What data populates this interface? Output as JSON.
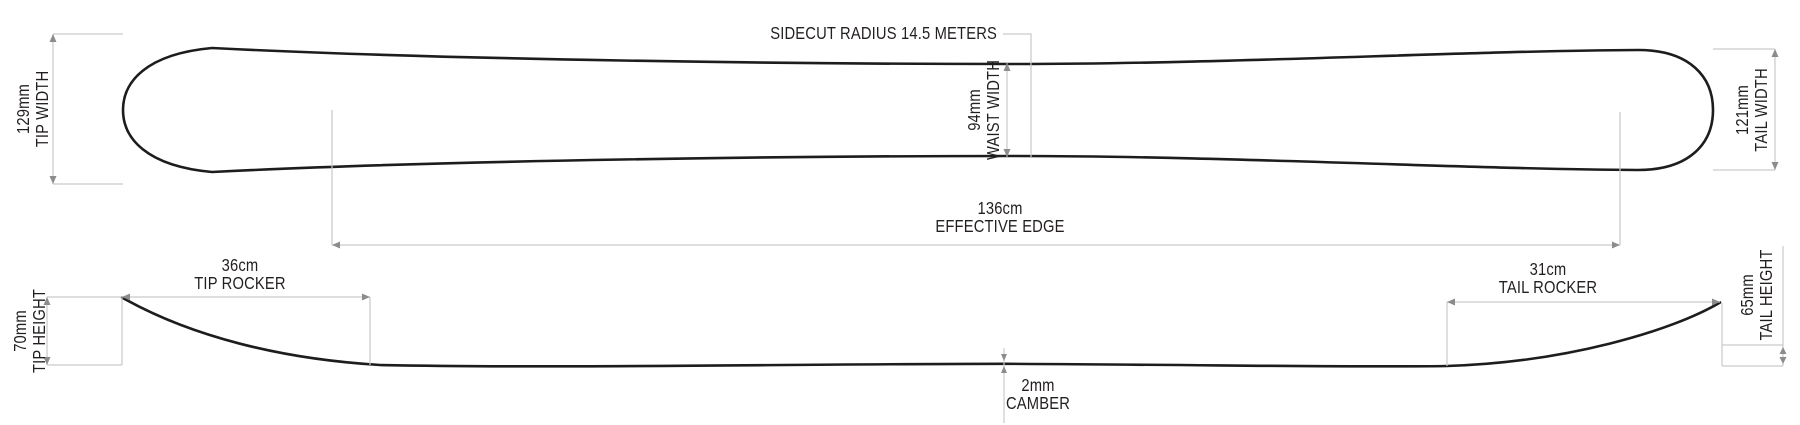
{
  "diagram": {
    "top_view": {
      "tip_width": {
        "value": "129mm",
        "label": "TIP WIDTH"
      },
      "sidecut": {
        "label": "SIDECUT RADIUS 14.5 METERS"
      },
      "waist_width": {
        "value": "94mm",
        "label": "WAIST WIDTH"
      },
      "tail_width": {
        "value": "121mm",
        "label": "TAIL WIDTH"
      },
      "effective_edge": {
        "value": "136cm",
        "label": "EFFECTIVE EDGE"
      }
    },
    "side_view": {
      "tip_height": {
        "value": "70mm",
        "label": "TIP HEIGHT"
      },
      "tip_rocker": {
        "value": "36cm",
        "label": "TIP ROCKER"
      },
      "camber": {
        "value": "2mm",
        "label": "CAMBER"
      },
      "tail_rocker": {
        "value": "31cm",
        "label": "TAIL ROCKER"
      },
      "tail_height": {
        "value": "65mm",
        "label": "TAIL HEIGHT"
      }
    },
    "colors": {
      "background": "#ffffff",
      "outline": "#1d1d1f",
      "dimension_line": "#c9c9c9",
      "arrowhead": "#8c8c8c",
      "text": "#231f20"
    }
  }
}
